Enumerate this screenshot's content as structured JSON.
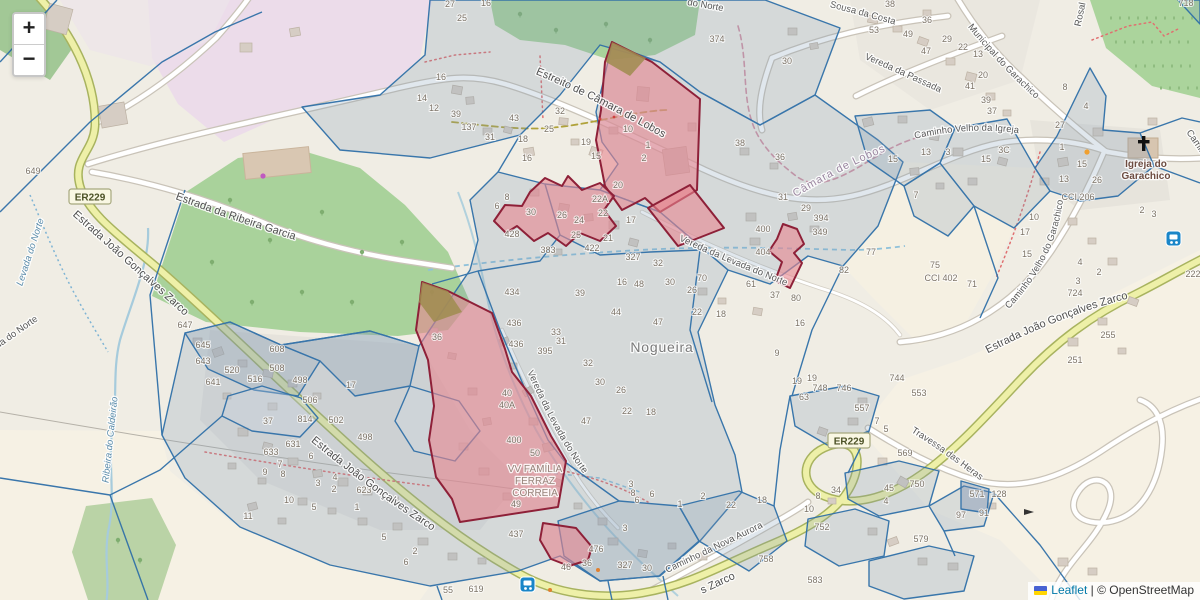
{
  "ui": {
    "zoom_in": "+",
    "zoom_out": "−",
    "attribution": {
      "leaflet": "Leaflet",
      "separator": " | ",
      "copyright": "© OpenStreetMap"
    }
  },
  "colors": {
    "parcel_stroke": "#3070a8",
    "parcel_fill": "rgba(125,150,180,0.25)",
    "highlight_fill": "rgba(232,133,143,0.6)",
    "highlight_stroke": "#8e2038",
    "road_yellow": "#eef0a8",
    "forest_green": "#a9d29b",
    "water_blue": "#a6cbdc",
    "link_blue": "#0078A8"
  },
  "map": {
    "place": "Nogueira",
    "labels": [
      {
        "text": "Estreito de Câmara de Lobos",
        "cls": "street",
        "path": "lp-estreito"
      },
      {
        "text": "Estrada da Ribeira Garcia",
        "cls": "street",
        "path": "lp-garcia"
      },
      {
        "text": "Estrada João Gonçalves Zarco",
        "cls": "street",
        "path": "lp-zarco1"
      },
      {
        "text": "Estrada João Gonçalves Zarco",
        "cls": "street",
        "path": "lp-zarco2"
      },
      {
        "text": "Estrada João Gonçalves Zarco",
        "cls": "street",
        "path": "lp-zarco3"
      },
      {
        "text": "s Zarco",
        "cls": "street",
        "x": 719,
        "y": 586,
        "rot": -25
      },
      {
        "text": "Vereda da Levada do Norte",
        "cls": "street-sm",
        "path": "lp-vln-n"
      },
      {
        "text": "Vereda da Levada do Norte",
        "cls": "street-sm",
        "path": "lp-vln-c"
      },
      {
        "text": "Caminho da Nova Aurora",
        "cls": "street-sm",
        "path": "lp-aurora"
      },
      {
        "text": "Travessa das Heras",
        "cls": "street-sm",
        "path": "lp-heras"
      },
      {
        "text": "Sousa da Costa",
        "cls": "street-sm",
        "path": "lp-costa"
      },
      {
        "text": "Municipal do Garachico",
        "cls": "street-sm",
        "path": "lp-municipal"
      },
      {
        "text": "Vereda da Passada",
        "cls": "street-sm",
        "path": "lp-passada"
      },
      {
        "text": "Caminho Velho da Igreja",
        "cls": "street-sm",
        "path": "lp-igreja"
      },
      {
        "text": "Caminho Velho do Garachico",
        "cls": "street-sm",
        "path": "lp-cvg"
      },
      {
        "text": "Caminho",
        "cls": "street-sm",
        "x": 1197,
        "y": 148,
        "rot": 55
      },
      {
        "text": "Câmara de Lobos",
        "cls": "admin",
        "path": "lp-lobos"
      },
      {
        "text": "Nogueira",
        "cls": "place",
        "x": 662,
        "y": 352,
        "rot": 0
      },
      {
        "text": "Igreja do",
        "cls": "poi",
        "x": 1146,
        "y": 167
      },
      {
        "text": "Garachico",
        "cls": "poi",
        "x": 1146,
        "y": 179
      },
      {
        "text": "VV FAMÍLIA",
        "cls": "site",
        "x": 535,
        "y": 472
      },
      {
        "text": "FERRAZ",
        "cls": "site",
        "x": 535,
        "y": 484
      },
      {
        "text": "CORREIA",
        "cls": "site",
        "x": 535,
        "y": 496
      },
      {
        "text": "Levada do Norte",
        "cls": "water",
        "x": 33,
        "y": 253,
        "rot": -72
      },
      {
        "text": "Ribeira do Caldeirão",
        "cls": "water",
        "x": 113,
        "y": 440,
        "rot": -84
      },
      {
        "text": "Vereda do Norte",
        "cls": "street-sm",
        "x": 10,
        "y": 340,
        "rot": -35
      },
      {
        "text": "do Norte",
        "cls": "street-sm",
        "x": 705,
        "y": 8,
        "rot": 10
      },
      {
        "text": "Rosal",
        "cls": "street-sm",
        "x": 1083,
        "y": 15,
        "rot": -78
      }
    ],
    "route_shields": [
      {
        "label": "ER229",
        "x": 90,
        "y": 197
      },
      {
        "label": "ER229",
        "x": 849,
        "y": 441
      }
    ],
    "house_numbers": [
      [
        "27",
        450,
        7
      ],
      [
        "16",
        486,
        6
      ],
      [
        "25",
        462,
        21
      ],
      [
        "16",
        441,
        80
      ],
      [
        "14",
        422,
        101
      ],
      [
        "12",
        434,
        111
      ],
      [
        "39",
        456,
        117
      ],
      [
        "43",
        514,
        121
      ],
      [
        "137",
        469,
        130
      ],
      [
        "31",
        490,
        140
      ],
      [
        "18",
        523,
        142
      ],
      [
        "16",
        527,
        161
      ],
      [
        "32",
        560,
        114
      ],
      [
        "25",
        549,
        132
      ],
      [
        "19",
        586,
        145
      ],
      [
        "15",
        596,
        159
      ],
      [
        "10",
        628,
        132
      ],
      [
        "1",
        648,
        148
      ],
      [
        "2",
        644,
        161
      ],
      [
        "20",
        618,
        188
      ],
      [
        "22A",
        600,
        202
      ],
      [
        "8",
        507,
        200
      ],
      [
        "6",
        497,
        209
      ],
      [
        "30",
        531,
        215
      ],
      [
        "26",
        562,
        218
      ],
      [
        "24",
        579,
        223
      ],
      [
        "22",
        603,
        216
      ],
      [
        "17",
        631,
        223
      ],
      [
        "25",
        576,
        238
      ],
      [
        "21",
        608,
        241
      ],
      [
        "422",
        592,
        251
      ],
      [
        "327",
        633,
        260
      ],
      [
        "383",
        548,
        253
      ],
      [
        "428",
        512,
        237
      ],
      [
        "374",
        717,
        42
      ],
      [
        "30",
        787,
        64
      ],
      [
        "38",
        890,
        7
      ],
      [
        "53",
        874,
        33
      ],
      [
        "49",
        908,
        37
      ],
      [
        "36",
        927,
        23
      ],
      [
        "29",
        947,
        42
      ],
      [
        "22",
        963,
        50
      ],
      [
        "13",
        978,
        57
      ],
      [
        "47",
        926,
        54
      ],
      [
        "20",
        983,
        78
      ],
      [
        "41",
        970,
        89
      ],
      [
        "39",
        986,
        103
      ],
      [
        "37",
        992,
        114
      ],
      [
        "27",
        1060,
        128
      ],
      [
        "8",
        1065,
        90
      ],
      [
        "4",
        1086,
        109
      ],
      [
        "718",
        1186,
        6
      ],
      [
        "15",
        893,
        162
      ],
      [
        "13",
        926,
        155
      ],
      [
        "3",
        948,
        155
      ],
      [
        "3C",
        1004,
        153
      ],
      [
        "7",
        916,
        198
      ],
      [
        "15",
        986,
        162
      ],
      [
        "1",
        1062,
        150
      ],
      [
        "15",
        1082,
        167
      ],
      [
        "13",
        1064,
        182
      ],
      [
        "26",
        1097,
        183
      ],
      [
        "CCI 206",
        1078,
        200
      ],
      [
        "2",
        1142,
        213
      ],
      [
        "3",
        1154,
        217
      ],
      [
        "10",
        1034,
        220
      ],
      [
        "17",
        1025,
        235
      ],
      [
        "15",
        1027,
        257
      ],
      [
        "4",
        1080,
        265
      ],
      [
        "2",
        1099,
        275
      ],
      [
        "3",
        1078,
        284
      ],
      [
        "724",
        1075,
        296
      ],
      [
        "255",
        1108,
        338
      ],
      [
        "251",
        1075,
        363
      ],
      [
        "222",
        1193,
        277
      ],
      [
        "77",
        871,
        255
      ],
      [
        "75",
        935,
        268
      ],
      [
        "CCI 402",
        941,
        281
      ],
      [
        "71",
        972,
        287
      ],
      [
        "38",
        740,
        146
      ],
      [
        "36",
        780,
        160
      ],
      [
        "31",
        783,
        200
      ],
      [
        "29",
        806,
        211
      ],
      [
        "394",
        821,
        221
      ],
      [
        "400",
        763,
        232
      ],
      [
        "404",
        763,
        255
      ],
      [
        "349",
        820,
        235
      ],
      [
        "82",
        844,
        273
      ],
      [
        "61",
        751,
        287
      ],
      [
        "37",
        775,
        298
      ],
      [
        "80",
        796,
        301
      ],
      [
        "70",
        702,
        281
      ],
      [
        "16",
        622,
        285
      ],
      [
        "48",
        639,
        287
      ],
      [
        "39",
        580,
        296
      ],
      [
        "44",
        616,
        315
      ],
      [
        "32",
        658,
        266
      ],
      [
        "30",
        670,
        285
      ],
      [
        "26",
        692,
        293
      ],
      [
        "22",
        697,
        315
      ],
      [
        "18",
        721,
        317
      ],
      [
        "47",
        658,
        325
      ],
      [
        "16",
        800,
        326
      ],
      [
        "9",
        777,
        356
      ],
      [
        "19",
        812,
        381
      ],
      [
        "434",
        512,
        295
      ],
      [
        "436",
        514,
        326
      ],
      [
        "436",
        516,
        347
      ],
      [
        "395",
        545,
        354
      ],
      [
        "36",
        437,
        340
      ],
      [
        "33",
        556,
        335
      ],
      [
        "31",
        561,
        344
      ],
      [
        "40",
        507,
        396
      ],
      [
        "40A",
        507,
        408
      ],
      [
        "400",
        514,
        443
      ],
      [
        "50",
        535,
        456
      ],
      [
        "49",
        516,
        507
      ],
      [
        "32",
        588,
        366
      ],
      [
        "30",
        600,
        385
      ],
      [
        "26",
        621,
        393
      ],
      [
        "22",
        627,
        414
      ],
      [
        "18",
        651,
        415
      ],
      [
        "47",
        586,
        424
      ],
      [
        "437",
        516,
        537
      ],
      [
        "476",
        596,
        552
      ],
      [
        "46",
        566,
        570
      ],
      [
        "36",
        587,
        566
      ],
      [
        "327",
        625,
        568
      ],
      [
        "30",
        647,
        571
      ],
      [
        "3",
        625,
        531
      ],
      [
        "3",
        631,
        487
      ],
      [
        "8",
        633,
        496
      ],
      [
        "6",
        637,
        503
      ],
      [
        "6",
        652,
        497
      ],
      [
        "1",
        680,
        507
      ],
      [
        "2",
        703,
        499
      ],
      [
        "22",
        731,
        508
      ],
      [
        "18",
        762,
        503
      ],
      [
        "758",
        766,
        562
      ],
      [
        "583",
        815,
        583
      ],
      [
        "579",
        921,
        542
      ],
      [
        "97",
        961,
        518
      ],
      [
        "91",
        984,
        516
      ],
      [
        "571",
        977,
        497
      ],
      [
        "128",
        999,
        497
      ],
      [
        "752",
        822,
        530
      ],
      [
        "10",
        809,
        512
      ],
      [
        "8",
        818,
        499
      ],
      [
        "34",
        836,
        493
      ],
      [
        "45",
        889,
        491
      ],
      [
        "4",
        886,
        504
      ],
      [
        "750",
        917,
        487
      ],
      [
        "569",
        905,
        456
      ],
      [
        "7",
        877,
        424
      ],
      [
        "5",
        886,
        432
      ],
      [
        "557",
        862,
        411
      ],
      [
        "553",
        919,
        396
      ],
      [
        "744",
        897,
        381
      ],
      [
        "748",
        820,
        391
      ],
      [
        "746",
        844,
        391
      ],
      [
        "63",
        804,
        400
      ],
      [
        "19",
        797,
        384
      ],
      [
        "608",
        277,
        352
      ],
      [
        "508",
        277,
        371
      ],
      [
        "498",
        300,
        383
      ],
      [
        "506",
        310,
        403
      ],
      [
        "502",
        336,
        423
      ],
      [
        "814",
        305,
        422
      ],
      [
        "498",
        365,
        440
      ],
      [
        "17",
        351,
        388
      ],
      [
        "37",
        268,
        424
      ],
      [
        "633",
        271,
        455
      ],
      [
        "631",
        293,
        447
      ],
      [
        "6",
        311,
        459
      ],
      [
        "7",
        280,
        467
      ],
      [
        "9",
        265,
        475
      ],
      [
        "8",
        283,
        477
      ],
      [
        "4",
        335,
        480
      ],
      [
        "3",
        318,
        486
      ],
      [
        "2",
        334,
        492
      ],
      [
        "623",
        364,
        493
      ],
      [
        "1",
        357,
        510
      ],
      [
        "10",
        289,
        503
      ],
      [
        "5",
        314,
        510
      ],
      [
        "11",
        248,
        519
      ],
      [
        "520",
        232,
        373
      ],
      [
        "516",
        255,
        382
      ],
      [
        "641",
        213,
        385
      ],
      [
        "643",
        203,
        364
      ],
      [
        "645",
        203,
        348
      ],
      [
        "647",
        185,
        328
      ],
      [
        "649",
        33,
        174
      ],
      [
        "55",
        448,
        593
      ],
      [
        "619",
        476,
        592
      ],
      [
        "5",
        384,
        540
      ],
      [
        "2",
        415,
        554
      ],
      [
        "6",
        406,
        565
      ]
    ]
  }
}
